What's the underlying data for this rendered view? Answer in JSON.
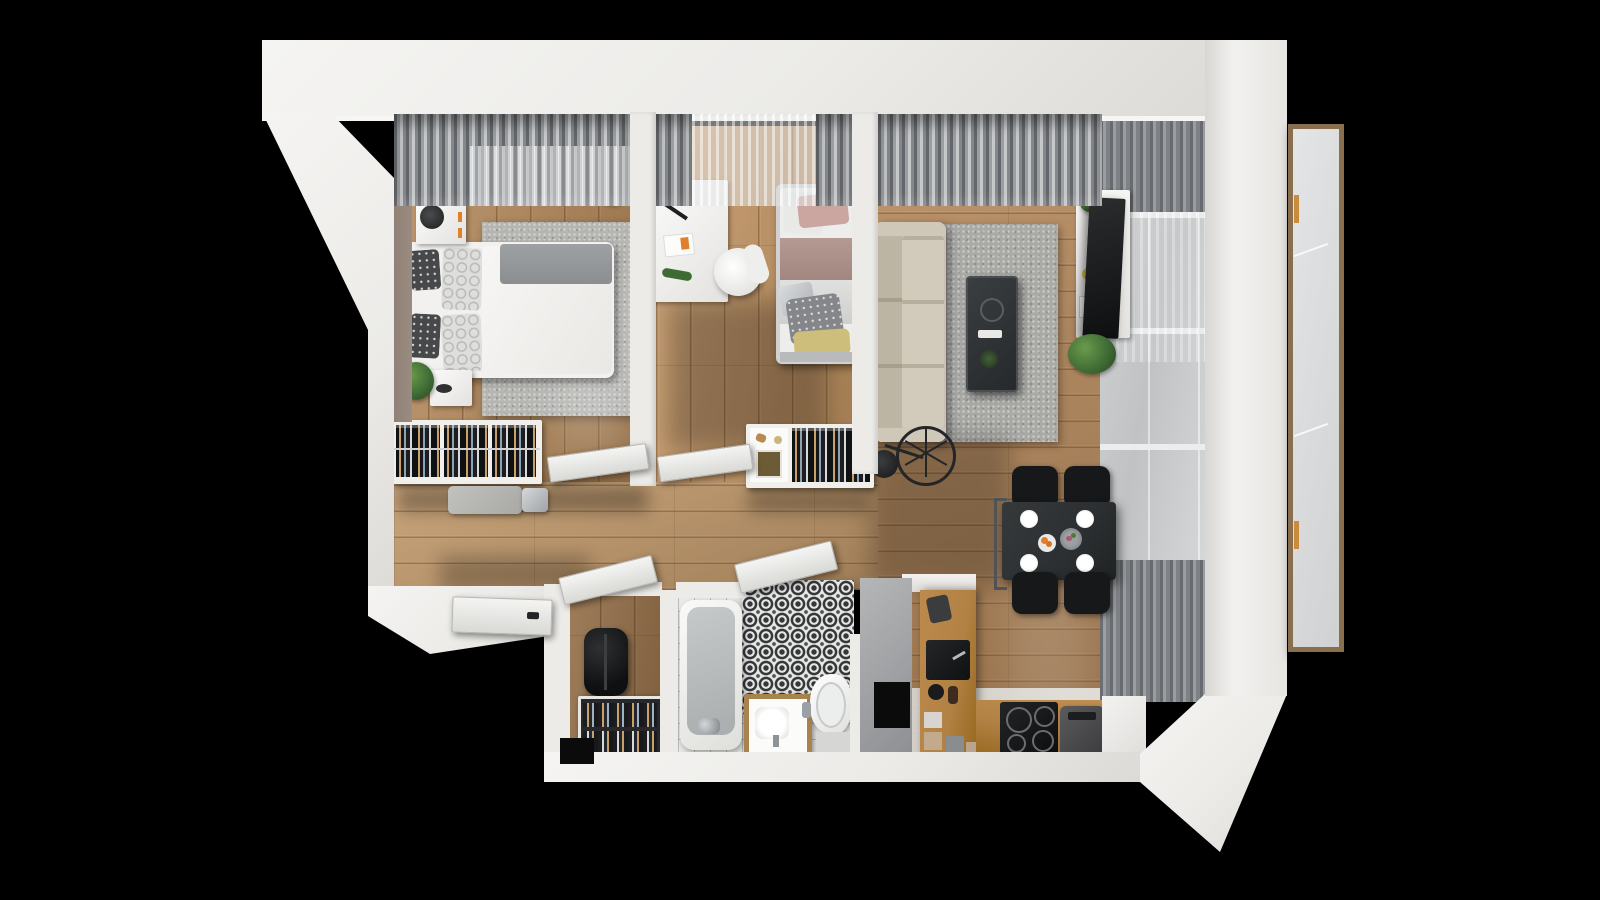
{
  "scene": {
    "kind": "3d-floor-plan-top-down-render",
    "description": "Photorealistic top-down 3D render of a furnished two-bedroom apartment on a black background",
    "visible_text": ""
  },
  "colors": {
    "bg": "#000000",
    "wall": "#ecebe8",
    "wall_shade": "#d8d6d2",
    "wall_face": "#9b8c81",
    "wood": "#b5895a",
    "wood_light": "#c2996a",
    "tile": "#e9eaea",
    "rug": "#b5b5b2",
    "sofa": "#c9c2b3",
    "glass": "#c0c2c4",
    "oak": "#b28144",
    "table_black": "#2c2f31",
    "chair_black": "#17181a",
    "pattern_dark": "#35373a",
    "bed_white": "#f2f1ef",
    "blanket_gray": "#9ea1a3",
    "plant_green": "#3e6b34",
    "frame_brown": "#8a6f4e",
    "accent_orange": "#e0802f"
  },
  "apartment": {
    "rooms": [
      {
        "id": "bedroom",
        "furniture": [
          "double-bed",
          "pillows",
          "nightstand-with-lamp",
          "nightstand-with-plant",
          "area-rug",
          "open-wardrobe-rack",
          "bench",
          "window-curtains"
        ]
      },
      {
        "id": "kids-room",
        "furniture": [
          "desk",
          "desk-lamp",
          "round-chair",
          "single-bed",
          "wardrobe-shelf-rack",
          "sheer-curtains"
        ]
      },
      {
        "id": "living-room",
        "furniture": [
          "sofa",
          "coffee-table",
          "tv-stand",
          "tv",
          "area-rug",
          "spoke-wheel-floor-lamp",
          "plants",
          "window-curtains"
        ]
      },
      {
        "id": "dining-area",
        "furniture": [
          "dining-table",
          "dining-chairs-x4",
          "plates",
          "fruit-plate"
        ]
      },
      {
        "id": "kitchen",
        "furniture": [
          "l-shaped-oak-counter",
          "sink",
          "induction-cooktop",
          "coffee-machine",
          "containers"
        ]
      },
      {
        "id": "bathroom",
        "furniture": [
          "bathtub",
          "faucet",
          "patterned-tile-wall",
          "vanity-sink",
          "toilet",
          "bath-mat"
        ]
      },
      {
        "id": "entry-closet",
        "furniture": [
          "backpack",
          "shoe-rack"
        ]
      },
      {
        "id": "hallway",
        "furniture": [
          "entrance-door",
          "open-interior-doors"
        ]
      }
    ],
    "exterior": [
      "white-shell-walls",
      "balcony-glass-door-panel",
      "window-band-with-blinds"
    ]
  }
}
